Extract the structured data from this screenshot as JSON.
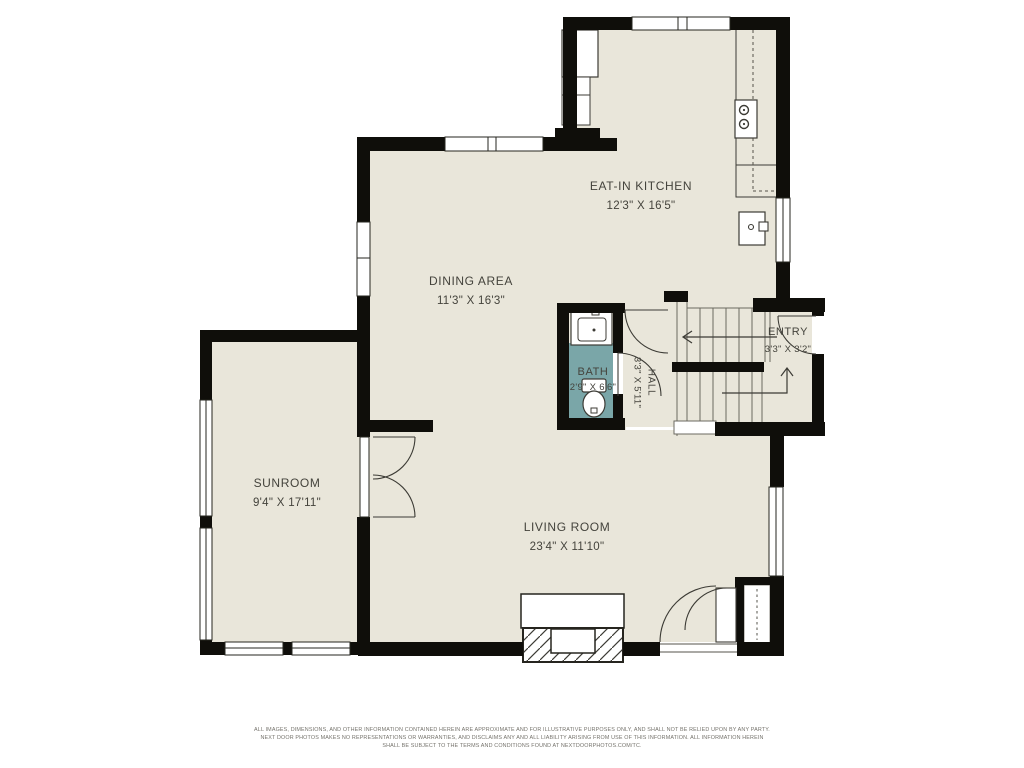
{
  "page": {
    "type": "residential-floor-plan"
  },
  "rooms": [
    {
      "id": "eat-in-kitchen",
      "label": "EAT-IN KITCHEN",
      "dims": "12'3\" X 16'5\""
    },
    {
      "id": "dining-area",
      "label": "DINING AREA",
      "dims": "11'3\" X 16'3\""
    },
    {
      "id": "bath",
      "label": "BATH",
      "dims": "2'9\" X 6'6\""
    },
    {
      "id": "hall",
      "label": "HALL",
      "dims": "3'3\" X 5'11\""
    },
    {
      "id": "entry",
      "label": "ENTRY",
      "dims": "3'3\" X 3'2\""
    },
    {
      "id": "sunroom",
      "label": "SUNROOM",
      "dims": "9'4\" X 17'11\""
    },
    {
      "id": "living-room",
      "label": "LIVING ROOM",
      "dims": "23'4\" X 11'10\""
    }
  ],
  "footer": {
    "line1": "ALL IMAGES, DIMENSIONS, AND OTHER INFORMATION CONTAINED HEREIN ARE APPROXIMATE AND FOR ILLUSTRATIVE PURPOSES ONLY, AND SHALL NOT BE RELIED UPON BY ANY PARTY.",
    "line2": "NEXT DOOR PHOTOS MAKES NO REPRESENTATIONS OR WARRANTIES, AND DISCLAIMS ANY AND ALL LIABILITY ARISING FROM USE OF THIS INFORMATION. ALL INFORMATION HEREIN",
    "line3": "SHALL BE SUBJECT TO THE TERMS AND CONDITIONS FOUND AT NEXTDOORPHOTOS.COM/TC."
  },
  "colors": {
    "floor": "#e9e6da",
    "walls": "#0f0e0a",
    "bath_floor": "#7aa6a8",
    "label_text": "#44433c",
    "disclaimer_text": "#75736c"
  }
}
